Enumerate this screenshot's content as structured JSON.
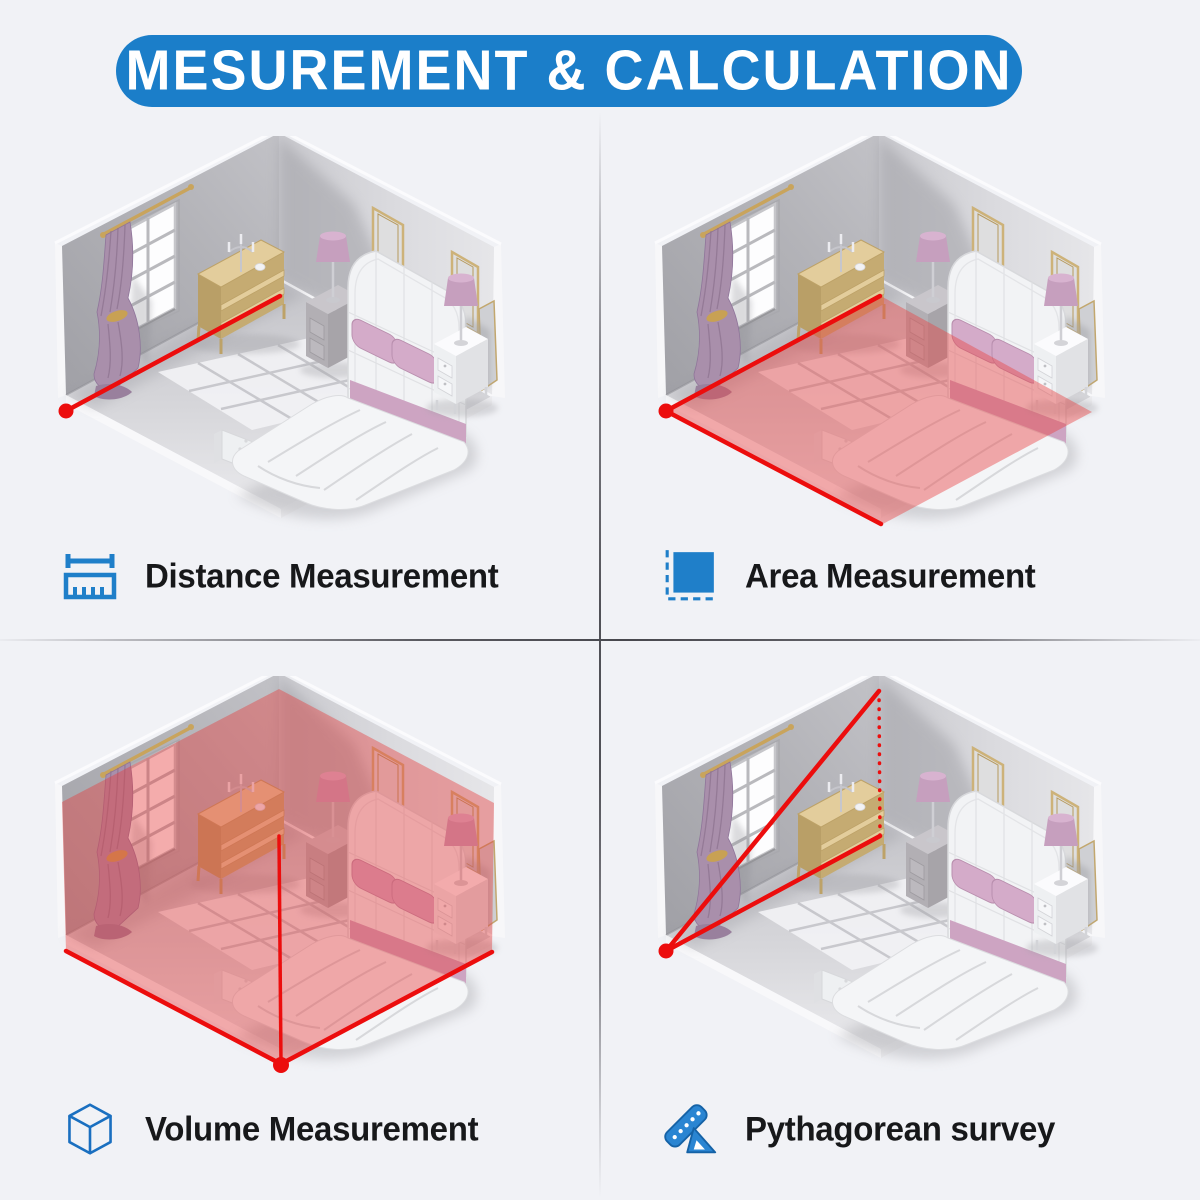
{
  "header": {
    "title": "MESUREMENT & CALCULATION"
  },
  "sections": [
    {
      "label": "Distance Measurement",
      "icon": "distance-ruler-icon",
      "position": "top-left",
      "overlay": "red laser line from room corner along wall base with red start dot"
    },
    {
      "label": "Area Measurement",
      "icon": "area-square-icon",
      "position": "top-right",
      "overlay": "floor tinted red with laser lines on two floor edges and red start dot"
    },
    {
      "label": "Volume Measurement",
      "icon": "volume-cube-icon",
      "position": "bottom-left",
      "overlay": "whole room tinted red, front floor edges and floor diagonal in red, dot at front vertex"
    },
    {
      "label": "Pythagorean survey",
      "icon": "set-square-icon",
      "position": "bottom-right",
      "overlay": "red hypotenuse to ceiling corner, base line to floor corner, dotted vertical height, red start dot"
    }
  ],
  "colors": {
    "accent_blue": "#1b7ec9",
    "laser_red": "#ec0d0d",
    "background": "#f1f2f6"
  }
}
